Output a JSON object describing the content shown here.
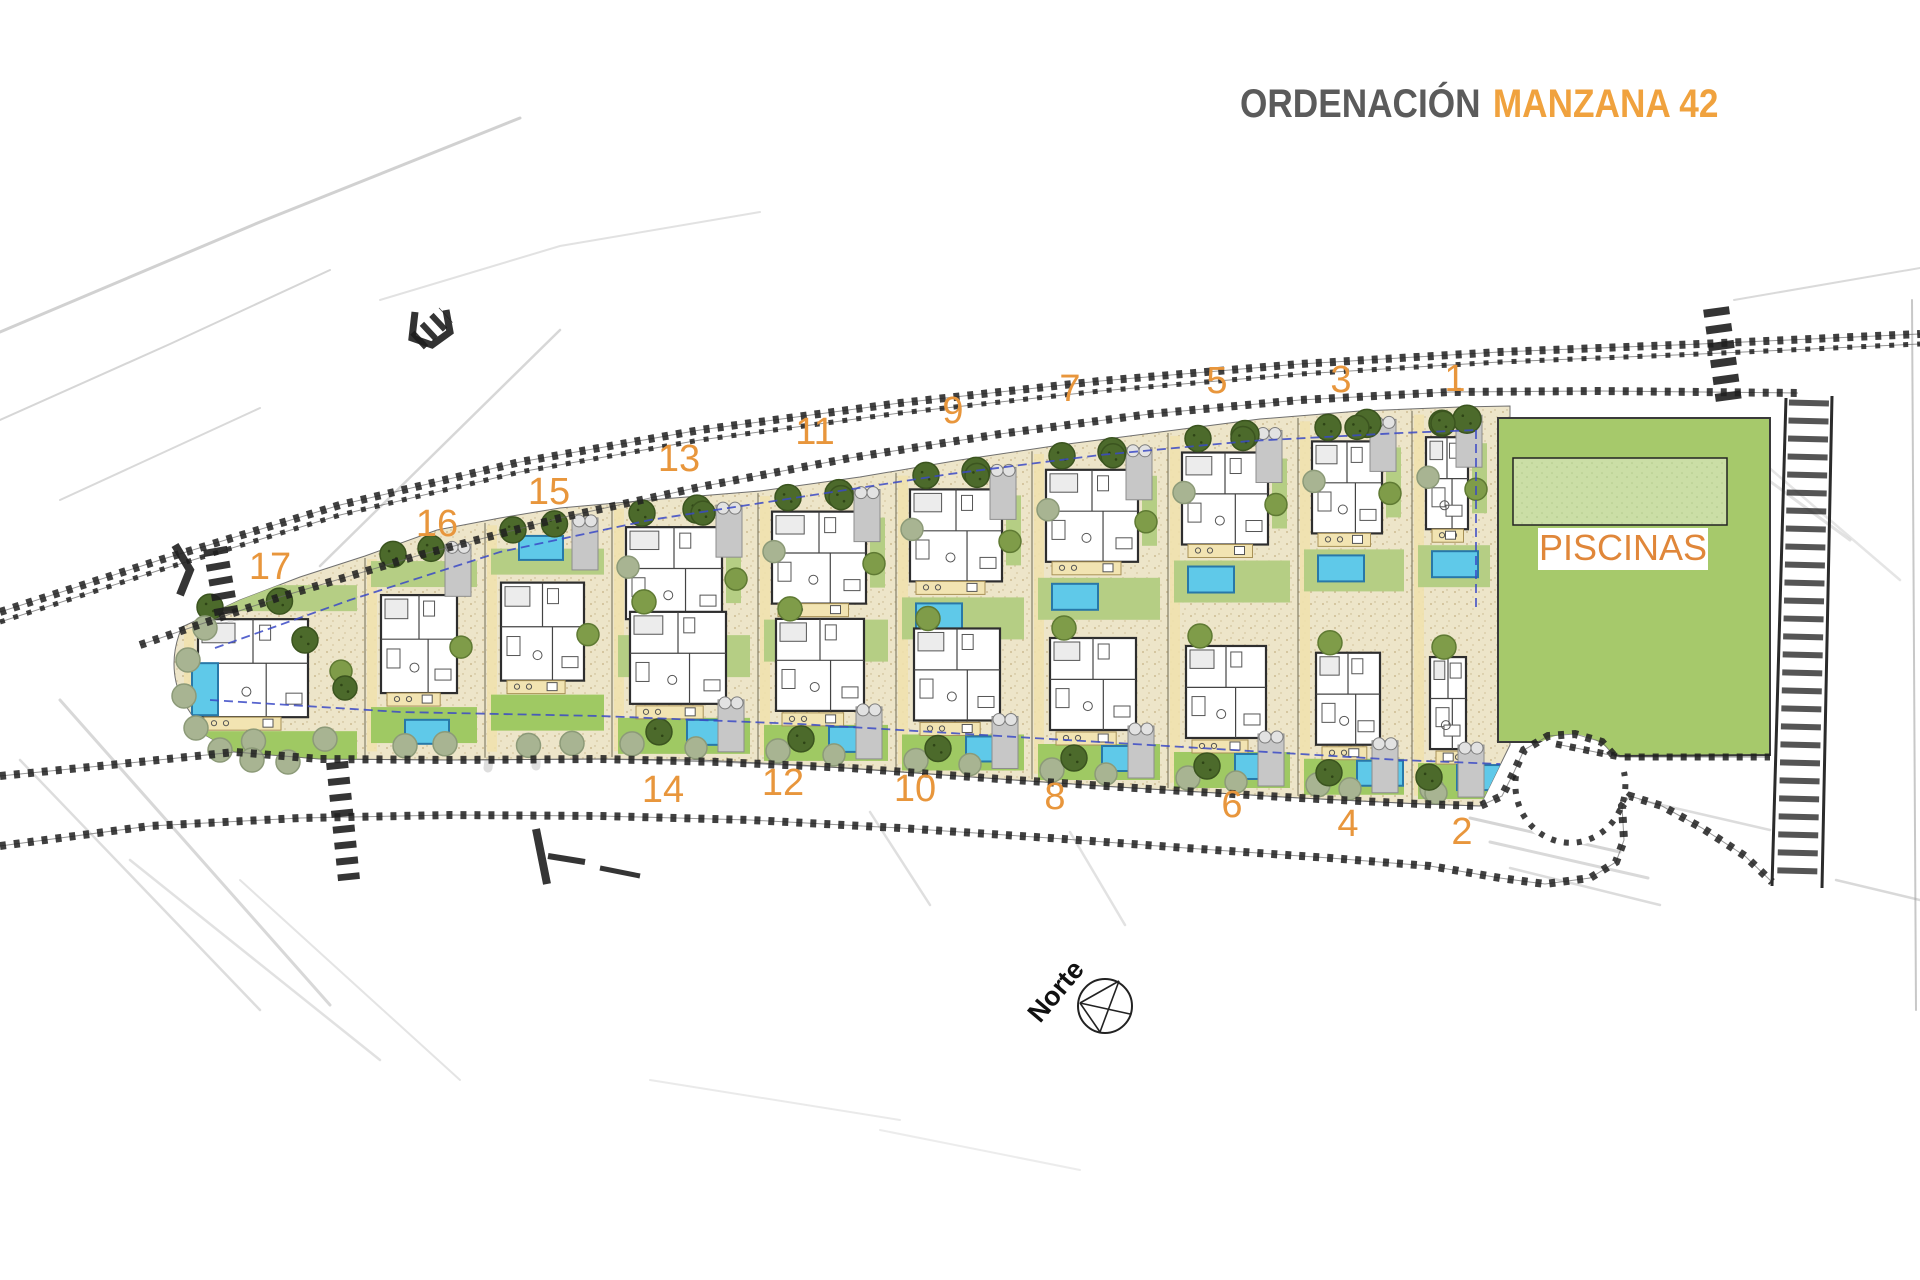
{
  "header": {
    "title_prefix": "ORDENACIÓN",
    "title_main": "MANZANA 42",
    "prefix_color": "#5b5b5b",
    "main_color": "#F0A23E"
  },
  "site_plan": {
    "north_label": "Norte",
    "area_label": "PISCINAS",
    "plot_number_color": "#E8963C",
    "area_label_color": "#E0873A",
    "colors": {
      "sand": "#EDE5C9",
      "lawn": "#B5CE84",
      "lawn_bright": "#9FC963",
      "piscinas_green": "#A6C96B",
      "piscinas_pool": "#CBDEA6",
      "pool_water": "#5FC9E9",
      "pool_border": "#2878A8",
      "tree_dark": "#4C6A2B",
      "tree_mid": "#7F9C49",
      "tree_sage": "#A8B492",
      "road": "#1F1F1F",
      "driveway": "#C7C7C7",
      "terrace": "#F2E4B2",
      "dashed_line": "#3A49C5"
    },
    "plots": [
      {
        "number": "1",
        "row": "upper",
        "x0": 1412,
        "x1": 1498,
        "label_x": 1455,
        "label_y": 391
      },
      {
        "number": "2",
        "row": "lower",
        "x0": 1412,
        "x1": 1498,
        "label_x": 1462,
        "label_y": 844
      },
      {
        "number": "3",
        "row": "upper",
        "x0": 1298,
        "x1": 1412,
        "label_x": 1341,
        "label_y": 392
      },
      {
        "number": "4",
        "row": "lower",
        "x0": 1298,
        "x1": 1412,
        "label_x": 1348,
        "label_y": 836
      },
      {
        "number": "5",
        "row": "upper",
        "x0": 1168,
        "x1": 1298,
        "label_x": 1217,
        "label_y": 393
      },
      {
        "number": "6",
        "row": "lower",
        "x0": 1168,
        "x1": 1298,
        "label_x": 1232,
        "label_y": 817
      },
      {
        "number": "7",
        "row": "upper",
        "x0": 1032,
        "x1": 1168,
        "label_x": 1070,
        "label_y": 401
      },
      {
        "number": "8",
        "row": "lower",
        "x0": 1032,
        "x1": 1168,
        "label_x": 1055,
        "label_y": 809
      },
      {
        "number": "9",
        "row": "upper",
        "x0": 896,
        "x1": 1032,
        "label_x": 953,
        "label_y": 423
      },
      {
        "number": "10",
        "row": "lower",
        "x0": 896,
        "x1": 1032,
        "label_x": 915,
        "label_y": 801
      },
      {
        "number": "11",
        "row": "upper",
        "x0": 758,
        "x1": 896,
        "label_x": 815,
        "label_y": 444
      },
      {
        "number": "12",
        "row": "lower",
        "x0": 758,
        "x1": 896,
        "label_x": 783,
        "label_y": 795
      },
      {
        "number": "13",
        "row": "upper",
        "x0": 612,
        "x1": 758,
        "label_x": 679,
        "label_y": 471
      },
      {
        "number": "14",
        "row": "lower",
        "x0": 612,
        "x1": 758,
        "label_x": 663,
        "label_y": 802
      },
      {
        "number": "15",
        "row": "full",
        "x0": 485,
        "x1": 612,
        "label_x": 549,
        "label_y": 504
      },
      {
        "number": "16",
        "row": "full",
        "x0": 365,
        "x1": 485,
        "label_x": 437,
        "label_y": 536
      },
      {
        "number": "17",
        "row": "full",
        "x0": 182,
        "x1": 365,
        "label_x": 270,
        "label_y": 579
      }
    ]
  }
}
